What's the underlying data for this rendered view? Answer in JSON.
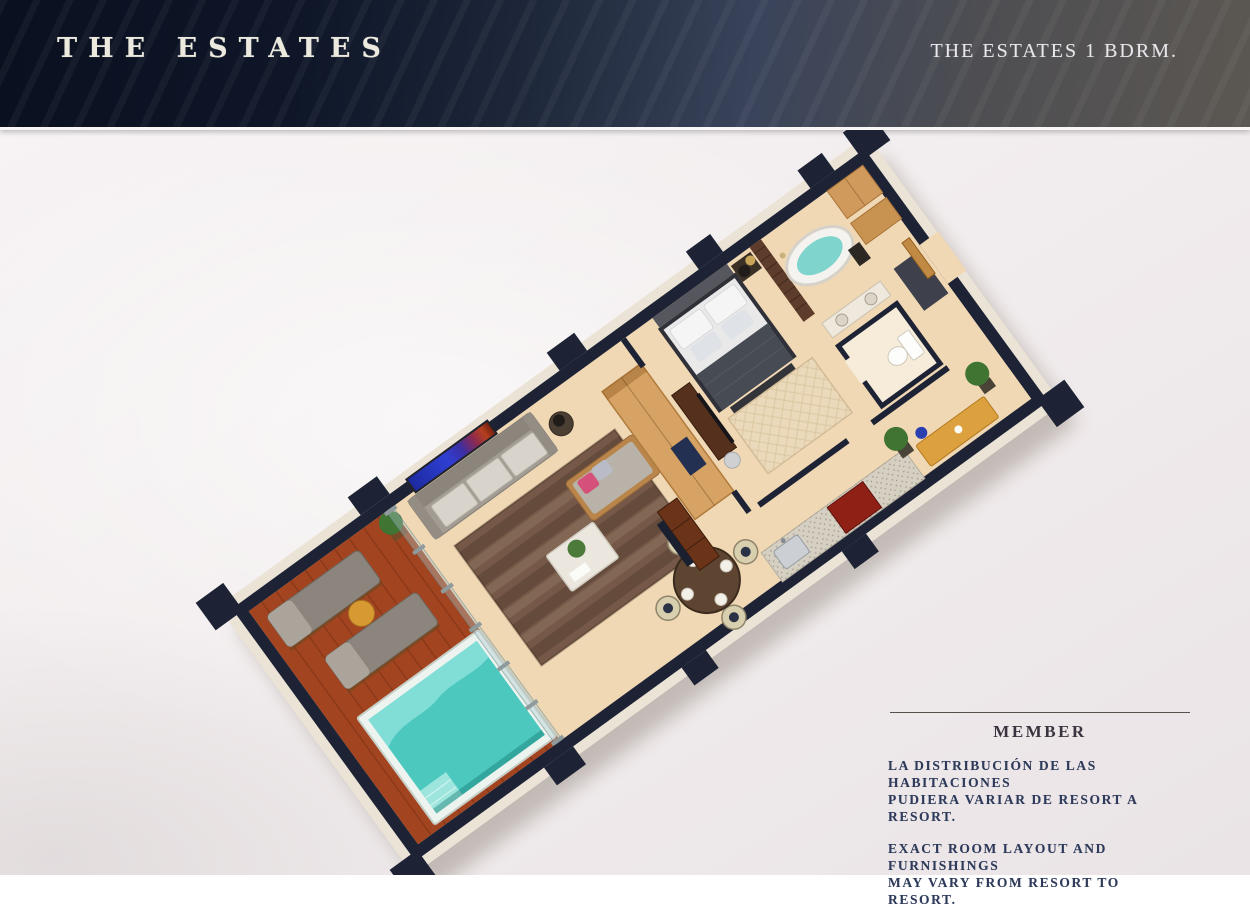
{
  "header": {
    "brand": "THE ESTATES",
    "unit_label": "THE ESTATES 1 BDRM."
  },
  "footer": {
    "member_label": "MEMBER",
    "disclaimer_es": "LA DISTRIBUCIÓN DE LAS HABITACIONES\nPUDIERA VARIAR DE RESORT A RESORT.",
    "disclaimer_en": "EXACT ROOM LAYOUT AND FURNISHINGS\nMAY VARY FROM RESORT TO RESORT."
  },
  "floorplan": {
    "features": [
      "balcony-deck",
      "lounge-chairs",
      "plunge-pool",
      "glass-railing",
      "living-room",
      "wall-art",
      "sofa",
      "floor-lamp",
      "area-rug",
      "coffee-table",
      "chaise-lounge",
      "dining-set",
      "wood-cabinetry",
      "media-console",
      "kitchen-counter",
      "corridor-bench",
      "potted-plants",
      "bedroom",
      "platform-bed",
      "nightstand",
      "bedroom-rug",
      "desk-tv",
      "bathroom",
      "freestanding-tub",
      "brick-feature-wall",
      "double-vanity",
      "water-closet",
      "toilet",
      "entry-closets",
      "entry-door"
    ]
  },
  "colors": {
    "page_bg": "#f2edee",
    "header_dark": "#0a101f",
    "header_mid": "#1d2739",
    "header_gray": "#5b5752",
    "title_ivory": "#ece9df",
    "label_ivory": "#e9e7ec",
    "member_text": "#3b3440",
    "body_text": "#2d3a5a",
    "rule": "#55504a",
    "wall_navy": "#1d2335",
    "wall_cream": "#eae3d6",
    "floor_beige": "#f0d8b4",
    "deck": "#a34420",
    "pool": "#4cc8bf",
    "pool_light": "#8ae2d9",
    "rug": "#755847",
    "sofa": "#a29c93",
    "lounger": "#8b857d",
    "cabinet": "#d6a365",
    "media": "#6b3317",
    "granite": "#d6d0c2",
    "bench": "#dda03e",
    "plant": "#3f7433",
    "red_cab": "#8e2016",
    "bed_dark": "#474b54"
  }
}
